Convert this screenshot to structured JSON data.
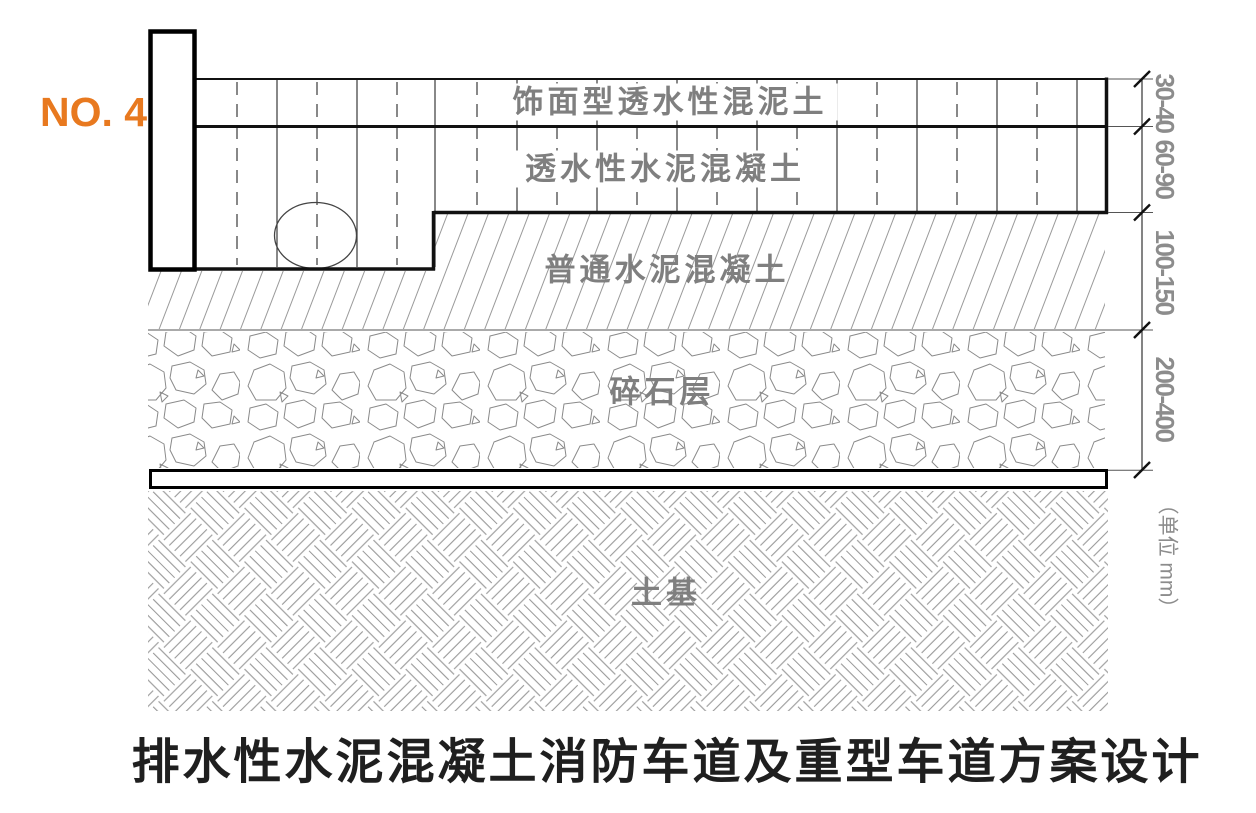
{
  "sheet": {
    "number_label": "NO. 4",
    "title": "排水性水泥混凝土消防车道及重型车道方案设计",
    "unit_note": "（单位 mm）"
  },
  "layers": [
    {
      "name": "饰面型透水性混泥土",
      "thickness_mm": "30-40"
    },
    {
      "name": "透水性水泥混凝土",
      "thickness_mm": "60-90"
    },
    {
      "name": "普通水泥混凝土",
      "thickness_mm": "100-150"
    },
    {
      "name": "碎石层",
      "thickness_mm": "200-400"
    },
    {
      "name": "土基"
    }
  ],
  "colors": {
    "accent_orange": "#e8791f",
    "label_gray": "#7f7f7f",
    "dimension_gray": "#8c8c8c",
    "line_black": "#111111",
    "hatch_gray": "#999999"
  }
}
